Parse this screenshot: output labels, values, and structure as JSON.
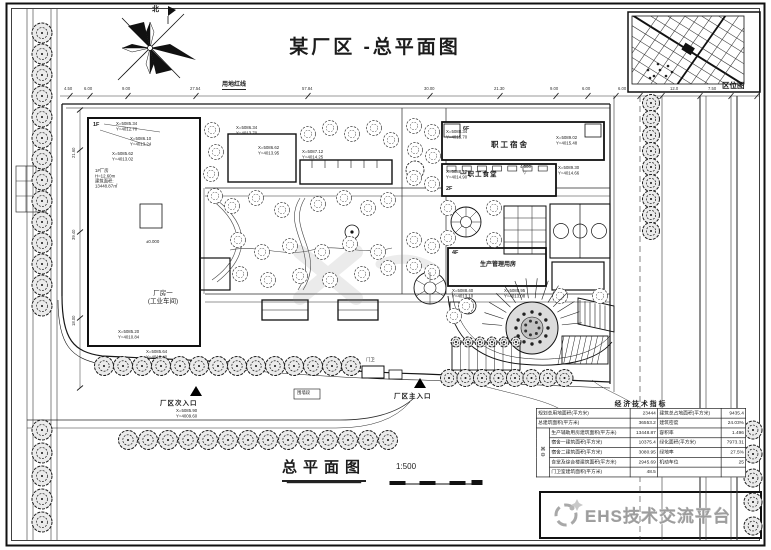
{
  "title": "某厂区 -总平面图",
  "north_label": "北",
  "location_map": {
    "label": "区位图"
  },
  "redline_label": "用地红线",
  "plan": {
    "factory_label": "厂房一\n(工业车间)",
    "factory_floor": "1F",
    "dorm_label": "职工宿舍",
    "dorm_floor": "6F",
    "canteen_label": "一职工食堂",
    "canteen_floor": "2F",
    "mgmt_label": "生产管理用房",
    "mgmt_floor": "4F",
    "entrance_secondary": "厂区次入口",
    "entrance_main": "厂区主入口"
  },
  "annotations": [
    {
      "x": 116,
      "y": 121,
      "t": "X=5085.34\nY=4012.70"
    },
    {
      "x": 130,
      "y": 136,
      "t": "X=5086.10\nY=4013.24"
    },
    {
      "x": 112,
      "y": 151,
      "t": "X=5085.62\nY=4013.02"
    },
    {
      "x": 95,
      "y": 168,
      "t": "1#厂房\nH=12.60m\n建筑面积:\n13448.87㎡"
    },
    {
      "x": 236,
      "y": 125,
      "t": "X=5086.34\nY=4013.70"
    },
    {
      "x": 258,
      "y": 145,
      "t": "X=5086.62\nY=4013.95"
    },
    {
      "x": 302,
      "y": 149,
      "t": "X=5087.12\nY=4014.25"
    },
    {
      "x": 446,
      "y": 129,
      "t": "X=5088.34\nY=4015.70"
    },
    {
      "x": 556,
      "y": 135,
      "t": "X=5089.02\nY=4015.48"
    },
    {
      "x": 446,
      "y": 169,
      "t": "X=5088.12\nY=4014.90"
    },
    {
      "x": 558,
      "y": 165,
      "t": "X=5089.30\nY=4014.66"
    },
    {
      "x": 452,
      "y": 288,
      "t": "X=5088.40\nY=4013.10"
    },
    {
      "x": 504,
      "y": 288,
      "t": "X=5088.95\nY=4013.08"
    },
    {
      "x": 118,
      "y": 329,
      "t": "X=5085.20\nY=4010.84"
    },
    {
      "x": 146,
      "y": 349,
      "t": "X=5085.64\nY=4010.40"
    },
    {
      "x": 176,
      "y": 408,
      "t": "X=5085.90\nY=4009.60"
    },
    {
      "x": 366,
      "y": 357,
      "t": "门卫"
    },
    {
      "x": 297,
      "y": 390,
      "t": "围墙段"
    },
    {
      "x": 146,
      "y": 239,
      "t": "±0.000"
    },
    {
      "x": 520,
      "y": 164,
      "t": "4.500"
    },
    {
      "x": 523,
      "y": 170,
      "t": "▽"
    }
  ],
  "dims_top": [
    {
      "x": 70,
      "t": "4.50"
    },
    {
      "x": 90,
      "t": "6.00"
    },
    {
      "x": 128,
      "t": "9.00"
    },
    {
      "x": 196,
      "t": "27.54"
    },
    {
      "x": 308,
      "t": "57.84"
    },
    {
      "x": 430,
      "t": "30.00"
    },
    {
      "x": 500,
      "t": "21.30"
    },
    {
      "x": 556,
      "t": "9.00"
    },
    {
      "x": 588,
      "t": "6.00"
    }
  ],
  "dims_left": [
    {
      "y": 150,
      "t": "21.60"
    },
    {
      "y": 232,
      "t": "39.40"
    },
    {
      "y": 318,
      "t": "18.00"
    }
  ],
  "dims_right": [
    {
      "x": 624,
      "t": "6.00"
    },
    {
      "x": 676,
      "t": "12.0"
    },
    {
      "x": 714,
      "t": "7.50"
    }
  ],
  "table": {
    "title": "经济技术指标",
    "category": "其\n中",
    "rows_left": [
      {
        "label": "规划总用地面积(平方米)",
        "value": "23444"
      },
      {
        "label": "总建筑面积(平方米)",
        "value": "36553.2"
      },
      {
        "label": "生产辅助用房建筑面积(平方米)",
        "value": "13448.87"
      },
      {
        "label": "宿舍一建筑面积(平方米)",
        "value": "10375.4"
      },
      {
        "label": "宿舍二建筑面积(平方米)",
        "value": "3080.95"
      },
      {
        "label": "食堂及综合楼建筑面积(平方米)",
        "value": "2945.69"
      },
      {
        "label": "门卫室建筑面积(平方米)",
        "value": "48.5"
      }
    ],
    "rows_right": [
      {
        "label": "建筑总占地面积(平方米)",
        "value": "9435.4"
      },
      {
        "label": "建筑密度",
        "value": "24.03%"
      },
      {
        "label": "容积率",
        "value": "1.496"
      },
      {
        "label": "绿化面积(平方米)",
        "value": "7973.31"
      },
      {
        "label": "绿地率",
        "value": "27.5%"
      },
      {
        "label": "机动车位",
        "value": "25"
      },
      {
        "label": "",
        "value": ""
      }
    ]
  },
  "footer": {
    "title": "总平面图",
    "scale": "1:500"
  },
  "logo_text": "EHS技术交流平台",
  "colors": {
    "ink": "#1c1c1c",
    "logo_gray": "#9d9d9d"
  },
  "decor": {
    "tree_rows": [
      {
        "x": 42,
        "y": 33,
        "dx": 0,
        "dy": 21,
        "n": 14,
        "r": 10,
        "s": "street"
      },
      {
        "x": 42,
        "y": 430,
        "dx": 0,
        "dy": 23,
        "n": 5,
        "r": 10,
        "s": "street"
      },
      {
        "x": 651,
        "y": 103,
        "dx": 0,
        "dy": 16,
        "n": 9,
        "r": 8.5,
        "s": "street"
      },
      {
        "x": 753,
        "y": 430,
        "dx": 0,
        "dy": 24,
        "n": 5,
        "r": 9,
        "s": "street"
      },
      {
        "x": 104,
        "y": 366,
        "dx": 19,
        "dy": 0,
        "n": 14,
        "r": 9.5,
        "s": "street"
      },
      {
        "x": 449,
        "y": 378,
        "dx": 16.5,
        "dy": 0,
        "n": 8,
        "r": 8.5,
        "s": "street"
      },
      {
        "x": 128,
        "y": 440,
        "dx": 20,
        "dy": 0,
        "n": 14,
        "r": 9.5,
        "s": "street"
      },
      {
        "x": 456,
        "y": 342,
        "dx": 12,
        "dy": 0,
        "n": 6,
        "r": 5,
        "s": "street"
      }
    ],
    "tree_points": [
      [
        212,
        130
      ],
      [
        216,
        152
      ],
      [
        211,
        174
      ],
      [
        215,
        196
      ],
      [
        308,
        134
      ],
      [
        330,
        128
      ],
      [
        352,
        134
      ],
      [
        374,
        128
      ],
      [
        391,
        140
      ],
      [
        232,
        206
      ],
      [
        256,
        198
      ],
      [
        282,
        210
      ],
      [
        318,
        204
      ],
      [
        344,
        198
      ],
      [
        368,
        208
      ],
      [
        388,
        200
      ],
      [
        238,
        240
      ],
      [
        262,
        252
      ],
      [
        290,
        246
      ],
      [
        322,
        252
      ],
      [
        350,
        244
      ],
      [
        378,
        252
      ],
      [
        240,
        274
      ],
      [
        268,
        280
      ],
      [
        300,
        276
      ],
      [
        330,
        280
      ],
      [
        362,
        274
      ],
      [
        388,
        268
      ],
      [
        414,
        126
      ],
      [
        432,
        132
      ],
      [
        415,
        150
      ],
      [
        433,
        156
      ],
      [
        414,
        178
      ],
      [
        432,
        184
      ],
      [
        414,
        240
      ],
      [
        432,
        246
      ],
      [
        414,
        266
      ],
      [
        432,
        272
      ],
      [
        448,
        208
      ],
      [
        494,
        208
      ],
      [
        448,
        238
      ],
      [
        494,
        240
      ],
      [
        560,
        296
      ],
      [
        600,
        296
      ],
      [
        454,
        316
      ],
      [
        466,
        306
      ]
    ],
    "plaza": {
      "cx": 532,
      "cy": 328
    }
  }
}
